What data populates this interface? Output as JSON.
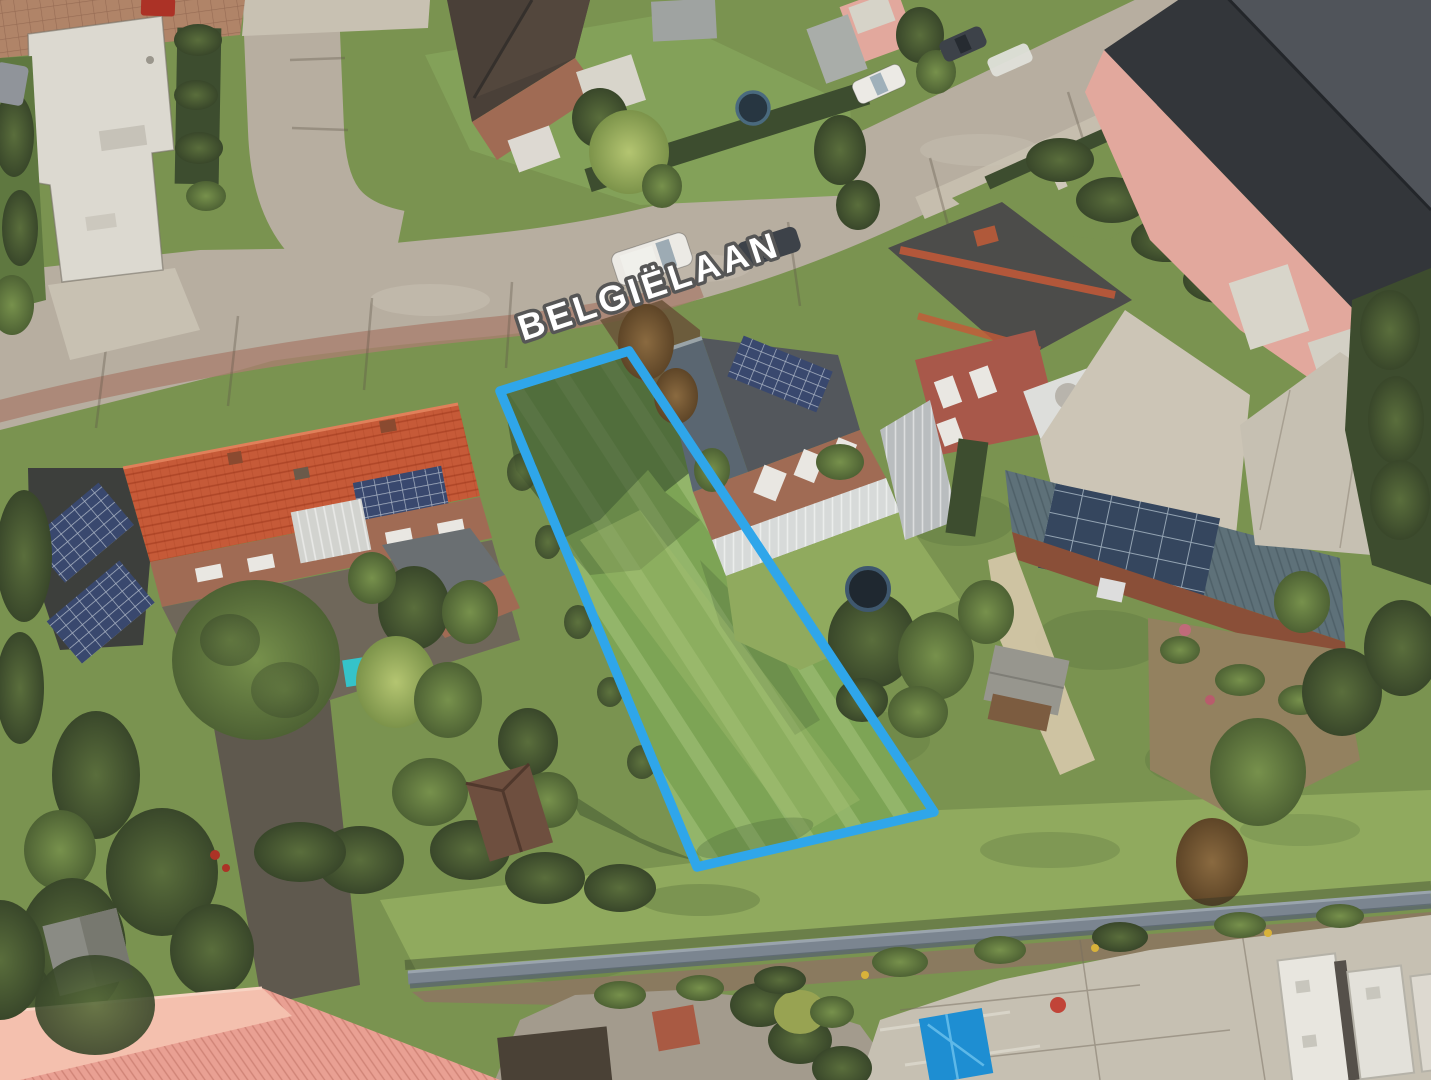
{
  "street": {
    "label": "BELGIËLAAN"
  },
  "plot": {
    "outline_points": "500,391 629,351 934,812 697,867",
    "outline_color": "#2FA6EA"
  },
  "colors": {
    "plot_outline": "#2FA6EA",
    "road": "#b7aea0",
    "road_light": "#c8c1b2",
    "red_paving": "#a97f6f",
    "grass_base": "#7a9350",
    "grass_light": "#90aa5e",
    "grass_plot": "#7da455",
    "plot_shadow": "#3a5130",
    "tree_dark": "#42522e",
    "tree_mid": "#5f7840",
    "tree_light": "#a8ba68",
    "hedge": "#3d4d2f",
    "brick": "#a06b54",
    "brick_red": "#a8584a",
    "pink_wall": "#e2a89d",
    "white_bldg": "#dcd9d0",
    "white_roof": "#d6d3c8",
    "roof_dark": "#33363a",
    "roof_dark_light": "#53575c",
    "roof_brown": "#4a4038",
    "roof_orange": "#c65a38",
    "roof_orange_dark": "#8f3c20",
    "roof_salmon": "#e9a093",
    "roof_salmon_light": "#f4c0ae",
    "roof_slate": "#5a6671",
    "solar_shed_roof": "#5e7179",
    "solar_panel": "#39486e",
    "concrete": "#c6c0b2",
    "asphalt": "#a39b8d",
    "dirt": "#93815f",
    "fence": "#7b8590",
    "fence_dark": "#5a656e",
    "tarp_blue": "#1e8ed2",
    "car_white": "#eceae5",
    "car_dark": "#3d4249",
    "car_red": "#ac3226",
    "teal_pool": "#35c3c9",
    "label_fill": "#ffffff",
    "label_stroke": "#565656"
  }
}
